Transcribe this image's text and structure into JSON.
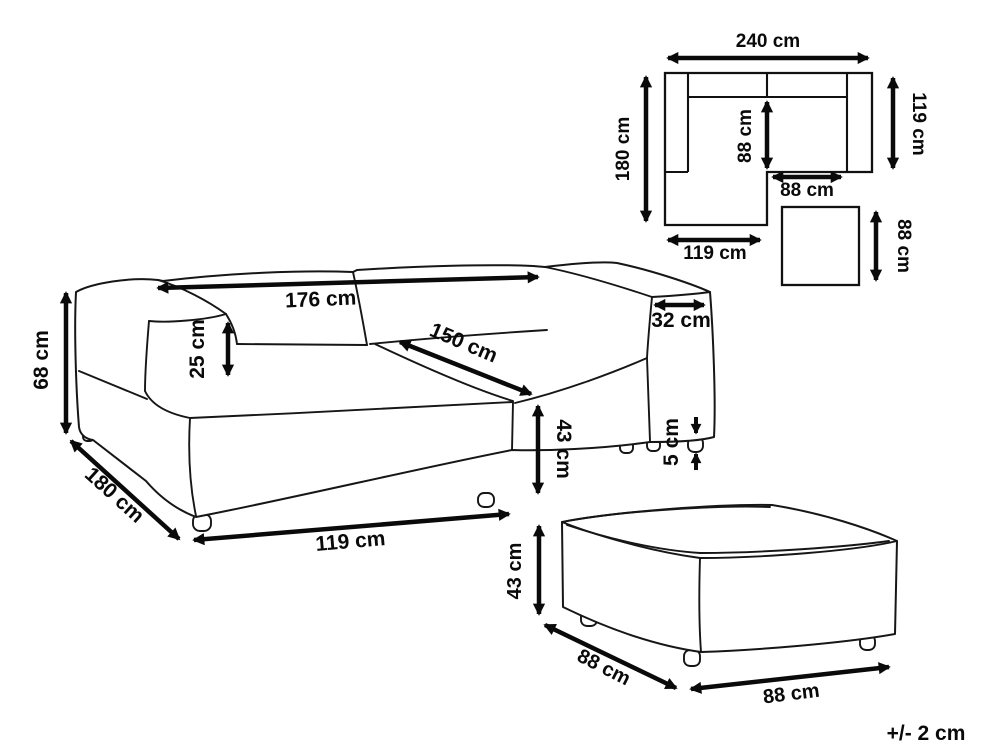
{
  "tolerance_label": "+/- 2 cm",
  "unit": "cm",
  "plan_view": {
    "overall_width_label": "240 cm",
    "overall_depth_label": "180 cm",
    "right_side_depth_label": "119 cm",
    "inner_seat_depth_label": "88 cm",
    "inner_seat_width_label": "88 cm",
    "chaise_width_label": "119 cm",
    "ottoman_size_label": "88 cm"
  },
  "sofa_view": {
    "overall_height_label": "68 cm",
    "chaise_depth_label": "180 cm",
    "chaise_front_width_label": "119 cm",
    "backrest_width_label": "176 cm",
    "armrest_above_seat_label": "25 cm",
    "seat_diagonal_label": "150 cm",
    "armrest_width_label": "32 cm",
    "seat_height_label": "43 cm",
    "leg_height_label": "5 cm"
  },
  "ottoman_view": {
    "height_label": "43 cm",
    "depth_label": "88 cm",
    "width_label": "88 cm"
  },
  "colors": {
    "line": "#161616",
    "background": "#ffffff"
  }
}
